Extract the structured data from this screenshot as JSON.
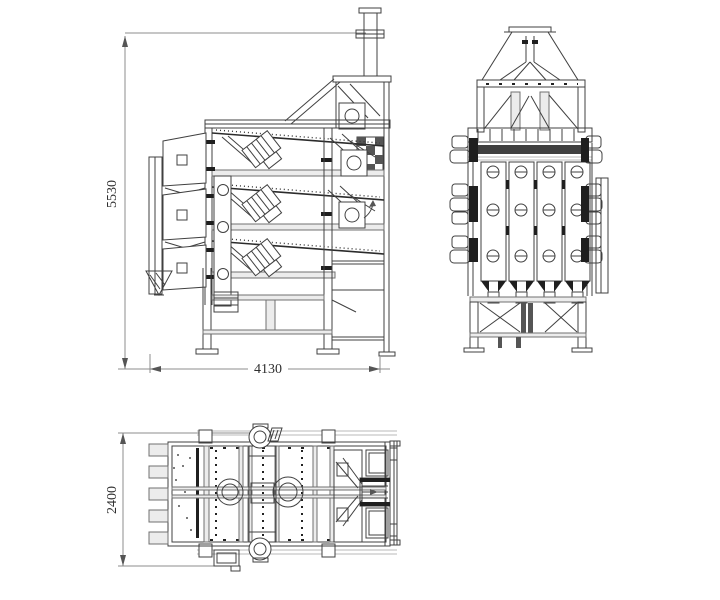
{
  "drawing": {
    "background_color": "#ffffff",
    "line_color": "#404040",
    "dim_line_color": "#8c8c8c",
    "views": {
      "side_elevation": {
        "dimensions": {
          "height": {
            "value": "5530",
            "axis": "vertical"
          },
          "length": {
            "value": "4130",
            "axis": "horizontal"
          }
        }
      },
      "end_elevation": {
        "dimensions": {}
      },
      "plan": {
        "dimensions": {
          "width": {
            "value": "2400",
            "axis": "vertical"
          }
        }
      }
    }
  }
}
